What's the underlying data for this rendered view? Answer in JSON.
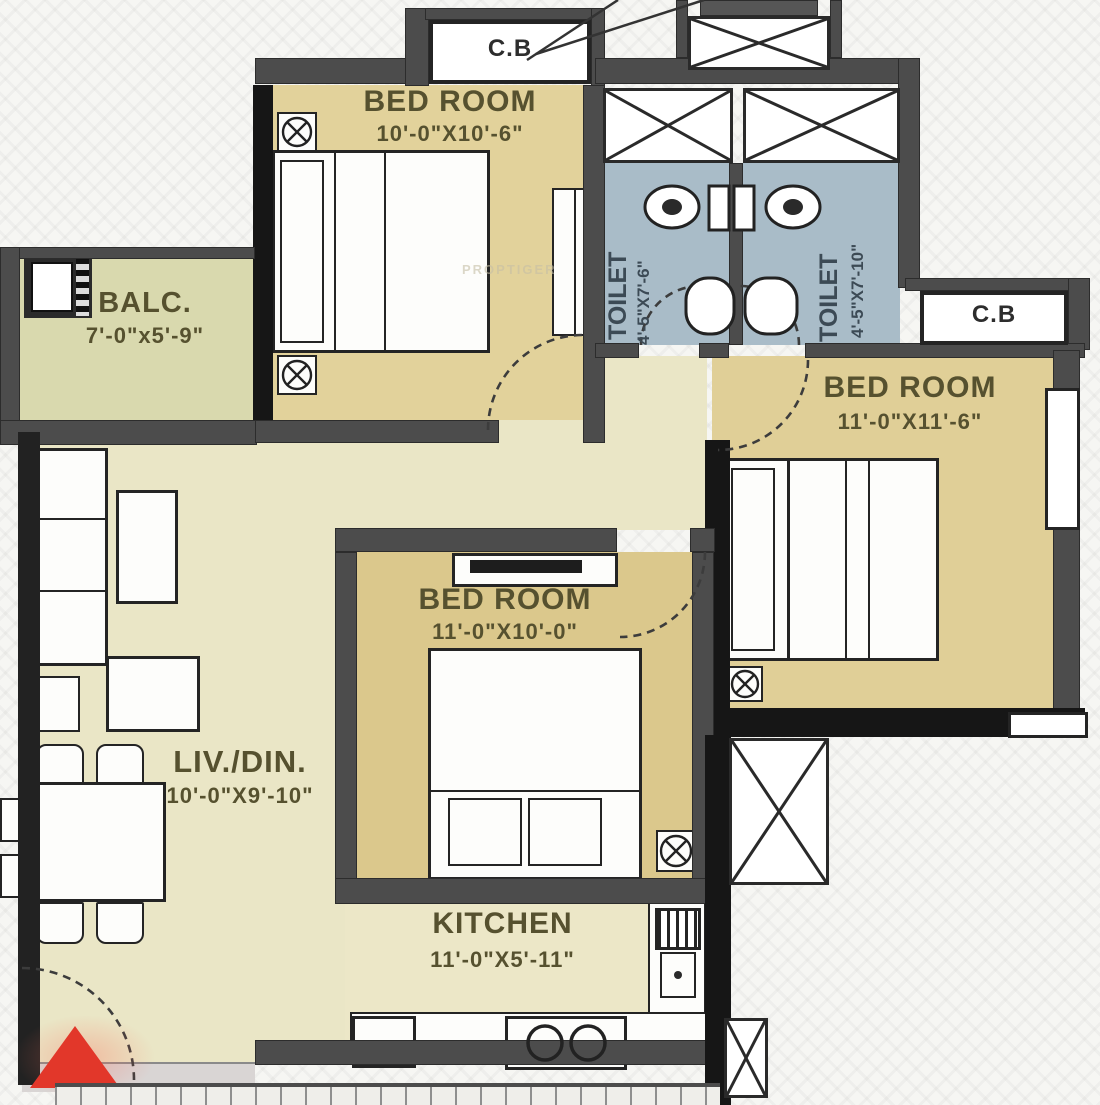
{
  "rooms": {
    "bedroom1": {
      "label": "BED ROOM",
      "dim": "10'-0\"X10'-6\""
    },
    "bedroom2": {
      "label": "BED ROOM",
      "dim": "11'-0\"X11'-6\""
    },
    "bedroom3": {
      "label": "BED ROOM",
      "dim": "11'-0\"X10'-0\""
    },
    "balcony": {
      "label": "BALC.",
      "dim": "7'-0\"x5'-9\""
    },
    "living": {
      "label": "LIV./DIN.",
      "dim": "10'-0\"X9'-10\""
    },
    "kitchen": {
      "label": "KITCHEN",
      "dim": "11'-0\"X5'-11\""
    },
    "toilet_left": {
      "label": "TOILET",
      "dim": "4'-5\"X7'-6\""
    },
    "toilet_right": {
      "label": "TOILET",
      "dim": "4'-5\"X7'-10\""
    },
    "cupboard_top": {
      "label": "C.B"
    },
    "cupboard_right": {
      "label": "C.B"
    }
  },
  "watermark": "PROPTIGER",
  "colors": {
    "bedroom_floor": "#e2d29b",
    "middle_bedroom_floor": "#dbc88c",
    "living_floor": "#eae6c6",
    "balcony_floor": "#d9d9ae",
    "toilet_floor": "#a9bcc8",
    "wall": "#4c4c4c",
    "entrance_arrow": "#e2372a"
  }
}
